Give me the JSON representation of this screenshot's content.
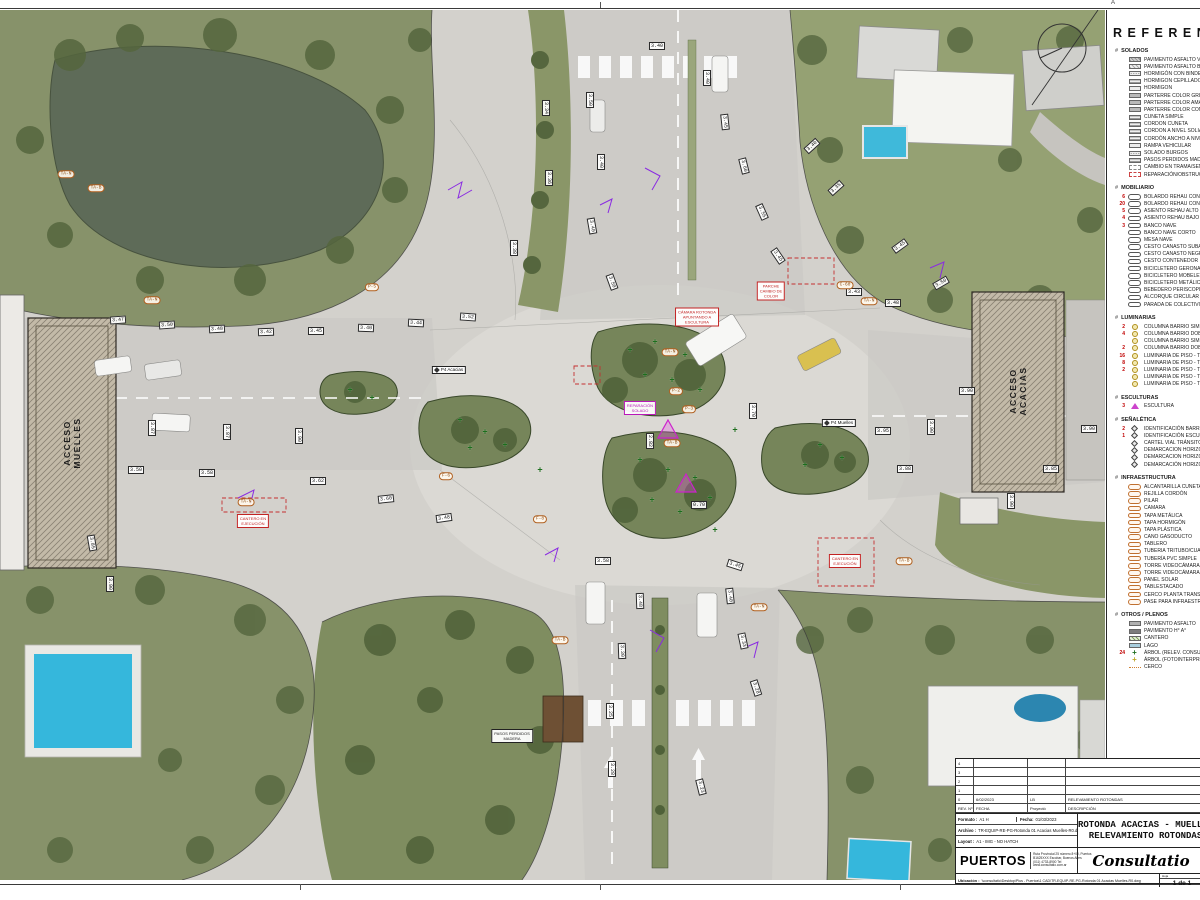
{
  "sheet": {
    "grid_letter": "A"
  },
  "legend": {
    "title": "REFERENCIAS",
    "hash": "#",
    "sections": [
      {
        "title": "SOLADOS",
        "items": [
          {
            "c": "",
            "icon": "hatch2",
            "label": "PAVIMENTO ASFALTO VEHICULAR"
          },
          {
            "c": "",
            "icon": "hatch1",
            "label": "PAVIMENTO ASFALTO BICISENDA"
          },
          {
            "c": "",
            "icon": "dots",
            "label": "HORMIGÓN CON BINDER"
          },
          {
            "c": "",
            "icon": "lines",
            "label": "HORMIGÓN CEPILLADO"
          },
          {
            "c": "",
            "icon": "light",
            "label": "HORMIGÓN"
          },
          {
            "c": "",
            "icon": "gray",
            "label": "PARTERRE COLOR GRIS"
          },
          {
            "c": "",
            "icon": "gray",
            "label": "PARTERRE COLOR AMARILLO"
          },
          {
            "c": "",
            "icon": "gray",
            "label": "PARTERRE COLOR COMB. AMARILLO Y ROJO"
          },
          {
            "c": "",
            "icon": "lines",
            "label": "CUNETA SIMPLE"
          },
          {
            "c": "",
            "icon": "lines",
            "label": "CORDÓN CUNETA"
          },
          {
            "c": "",
            "icon": "lines",
            "label": "CORDÓN A NIVEL SOLIA INTERTRABADA"
          },
          {
            "c": "",
            "icon": "lines",
            "label": "CORDÓN ANCHO A NIVEL SOLIA INTERTRABADA"
          },
          {
            "c": "",
            "icon": "light",
            "label": "RAMPA VEHICULAR"
          },
          {
            "c": "",
            "icon": "dots",
            "label": "SOLADO BURGOS"
          },
          {
            "c": "",
            "icon": "lines",
            "label": "PASOS PERDIDOS MADERA"
          },
          {
            "c": "",
            "icon": "dashg",
            "label": "CAMBIO EN TRAMA/SENTIDO ADOQUINADO"
          },
          {
            "c": "",
            "icon": "dashr",
            "label": "REPARACIÓN/OBSTRUCCIÓN EN SOLADO"
          }
        ]
      },
      {
        "title": "MOBILIARIO",
        "items": [
          {
            "c": "6",
            "icon": "oval",
            "label": "BOLARDO REHAU CON LUZ"
          },
          {
            "c": "20",
            "icon": "oval",
            "label": "BOLARDO REHAU CON REFLECTIVO"
          },
          {
            "c": "5",
            "icon": "oval",
            "label": "ASIENTO REHAU ALTO"
          },
          {
            "c": "4",
            "icon": "oval",
            "label": "ASIENTO REHAU BAJO"
          },
          {
            "c": "3",
            "icon": "oval",
            "label": "BANCO NAVE"
          },
          {
            "c": "",
            "icon": "oval",
            "label": "BANCO NAVE CORTO"
          },
          {
            "c": "",
            "icon": "oval",
            "label": "MESA NAVE"
          },
          {
            "c": "",
            "icon": "oval",
            "label": "CESTO CANASTO SUBA"
          },
          {
            "c": "",
            "icon": "oval",
            "label": "CESTO CANASTO NEGRO"
          },
          {
            "c": "",
            "icon": "oval",
            "label": "CESTO CONTENEDOR"
          },
          {
            "c": "",
            "icon": "oval",
            "label": "BICICLETERO GERONA"
          },
          {
            "c": "",
            "icon": "oval",
            "label": "BICICLETERO MOBELETTA"
          },
          {
            "c": "",
            "icon": "oval",
            "label": "BICICLETERO METÁLICO"
          },
          {
            "c": "",
            "icon": "oval",
            "label": "BEBEDERO PERISCOPIO"
          },
          {
            "c": "",
            "icon": "oval",
            "label": "ALCORQUE CIRCULAR SIMPLE"
          },
          {
            "c": "",
            "icon": "oval",
            "label": "PARADA DE COLECTIVO"
          }
        ]
      },
      {
        "title": "LUMINARIAS",
        "items": [
          {
            "c": "2",
            "icon": "circy",
            "label": "COLUMNA BARRIO SIMPLE VIAL ALTA"
          },
          {
            "c": "4",
            "icon": "circy",
            "label": "COLUMNA BARRIO DOBLE VIAL ALTA"
          },
          {
            "c": "",
            "icon": "circy",
            "label": "COLUMNA BARRIO SIMPLE PEATONAL BAJA"
          },
          {
            "c": "2",
            "icon": "circy",
            "label": "COLUMNA BARRIO DOBLE PEATONAL BAJA"
          },
          {
            "c": "16",
            "icon": "circy",
            "label": "LUMINARIA DE PISO - TIPO RECTANGULAR"
          },
          {
            "c": "8",
            "icon": "circy",
            "label": "LUMINARIA DE PISO - TIPO CILINDRO ALTO"
          },
          {
            "c": "2",
            "icon": "circy",
            "label": "LUMINARIA DE PISO - TIPO CILINDRO BAJO"
          },
          {
            "c": "",
            "icon": "circy",
            "label": "LUMINARIA DE PISO - TIPO EMPOTRABLE"
          },
          {
            "c": "",
            "icon": "circy",
            "label": "LUMINARIA DE PISO - TIPO TIRA LED"
          }
        ]
      },
      {
        "title": "ESCULTURAS",
        "items": [
          {
            "c": "3",
            "icon": "trim",
            "label": "ESCULTURA"
          }
        ]
      },
      {
        "title": "SEÑALÉTICA",
        "items": [
          {
            "c": "2",
            "icon": "diam",
            "label": "IDENTIFICACIÓN BARRIO"
          },
          {
            "c": "1",
            "icon": "diam",
            "label": "IDENTIFICACIÓN ESCULTURA"
          },
          {
            "c": "",
            "icon": "diam",
            "label": "CARTEL VIAL TRÁNSITO-ORIENTACIÓN"
          },
          {
            "c": "",
            "icon": "diam",
            "label": "DEMARCACIÓN HORIZONTAL VIAL"
          },
          {
            "c": "",
            "icon": "diam",
            "label": "DEMARCACIÓN HORIZONTAL ROTONDA"
          },
          {
            "c": "",
            "icon": "diam",
            "label": "DEMARCACIÓN HORIZONTAL BICISENDA"
          }
        ]
      },
      {
        "title": "INFRAESTRUCTURA",
        "items": [
          {
            "c": "",
            "icon": "ovalo",
            "label": "ALCANTARILLA CUNETA"
          },
          {
            "c": "",
            "icon": "ovalo",
            "label": "REJILLA CORDÓN"
          },
          {
            "c": "",
            "icon": "ovalo",
            "label": "PILAR"
          },
          {
            "c": "",
            "icon": "ovalo",
            "label": "CÁMARA"
          },
          {
            "c": "",
            "icon": "ovalo",
            "label": "TAPA METÁLICA"
          },
          {
            "c": "",
            "icon": "ovalo",
            "label": "TAPA HORMIGÓN"
          },
          {
            "c": "",
            "icon": "ovalo",
            "label": "TAPA PLÁSTICA"
          },
          {
            "c": "",
            "icon": "ovalo",
            "label": "CAÑO GASODUCTO"
          },
          {
            "c": "",
            "icon": "ovalo",
            "label": "TABLERO"
          },
          {
            "c": "",
            "icon": "ovalo",
            "label": "TUBERÍA TRITUBO/CUATRITUBO"
          },
          {
            "c": "",
            "icon": "ovalo",
            "label": "TUBERÍA PVC SIMPLE"
          },
          {
            "c": "",
            "icon": "ovalo",
            "label": "TORRE VIDEOCÁMARA SIMPLE"
          },
          {
            "c": "",
            "icon": "ovalo",
            "label": "TORRE VIDEOCÁMARA MÚLTIPLE"
          },
          {
            "c": "",
            "icon": "ovalo",
            "label": "PANEL SOLAR"
          },
          {
            "c": "",
            "icon": "ovalo",
            "label": "TABLESTACADO"
          },
          {
            "c": "",
            "icon": "ovalo",
            "label": "CERCO PLANTA TRANSFORMADORA"
          },
          {
            "c": "",
            "icon": "ovalo",
            "label": "PASE PARA INFRAESTRUCTURA (EN DESUSO)"
          }
        ]
      },
      {
        "title": "OTROS / PLENOS",
        "items": [
          {
            "c": "",
            "icon": "swasph",
            "label": "PAVIMENTO ASFALTO"
          },
          {
            "c": "",
            "icon": "swha",
            "label": "PAVIMENTO H° A°"
          },
          {
            "c": "",
            "icon": "swcant",
            "label": "CANTERO"
          },
          {
            "c": "",
            "icon": "swlago",
            "label": "LAGO"
          },
          {
            "c": "24",
            "icon": "plusg",
            "label": "ÁRBOL (RELEV. CONSULTATIO)"
          },
          {
            "c": "",
            "icon": "plusy",
            "label": "ÁRBOL (FOTOINTERPRETACIÓN)"
          },
          {
            "c": "",
            "icon": "cerco",
            "label": "CERCO"
          }
        ]
      }
    ]
  },
  "title_block": {
    "rev_table": {
      "headers": [
        "REV. Nº",
        "FECHA",
        "Proyectó",
        "DESCRIPCIÓN"
      ],
      "rows": [
        [
          "4",
          "",
          "",
          ""
        ],
        [
          "3",
          "",
          "",
          ""
        ],
        [
          "2",
          "",
          "",
          ""
        ],
        [
          "1",
          "",
          "",
          ""
        ],
        [
          "0",
          "6/02/2023",
          "LB",
          "RELEVAMIENTO ROTONDAS"
        ]
      ]
    },
    "formato_label": "Formato :",
    "formato": "A1 H",
    "fecha_label": "Fecha:",
    "fecha": "01/03/2023",
    "archivo_label": "Archivo :",
    "archivo": "TR-EQUIP-RE-PG-Rotonda 01 Acacias Muelles-R0.dwg",
    "layout_label": "Layout :",
    "layout": "A1 - IMG - NO HATCH",
    "title_lines": [
      "ROTONDA ACACIAS - MUELLES",
      "RELEVAMIENTO ROTONDAS"
    ],
    "brand": {
      "name": "PUERTOS",
      "address": [
        "Ruta Provincial 25 número 8+00, Puertos",
        "B1625XXX Escobar, Buenos Aires",
        "(011) 4733-8900  Tel",
        "www.consultatio.com.ar"
      ],
      "consultatio": "Consultatio"
    },
    "ubicacion_label": "Ubicación :",
    "ubicacion": "\\\\consultatio\\Desktop\\Plus - Puertos\\1 CAD\\TR-EQUIP-RE-PG-Rotonda 01 Acacias Muelles-R0.dwg",
    "hoja_label": "Hoja",
    "hoja": "1 de 1"
  },
  "map": {
    "building_labels": [
      {
        "line1": "ACCESO",
        "line2": "MUELLES",
        "x": 72,
        "y": 443
      },
      {
        "line1": "ACCESO",
        "line2": "ACACIAS",
        "x": 1018,
        "y": 391
      }
    ],
    "dims": [
      {
        "t": "3.34",
        "x": 546,
        "y": 108,
        "r": 90
      },
      {
        "t": "3.36",
        "x": 549,
        "y": 178,
        "r": 90
      },
      {
        "t": "3.38",
        "x": 514,
        "y": 248,
        "r": 90
      },
      {
        "t": "3.50",
        "x": 590,
        "y": 100,
        "r": 90
      },
      {
        "t": "3.40",
        "x": 601,
        "y": 162,
        "r": 90
      },
      {
        "t": "3.40",
        "x": 592,
        "y": 226,
        "r": 80
      },
      {
        "t": "3.50",
        "x": 612,
        "y": 282,
        "r": 70
      },
      {
        "t": "3.40",
        "x": 657,
        "y": 46,
        "r": 0
      },
      {
        "t": "3.40",
        "x": 707,
        "y": 78,
        "r": 90
      },
      {
        "t": "3.45",
        "x": 725,
        "y": 122,
        "r": 84
      },
      {
        "t": "3.60",
        "x": 744,
        "y": 166,
        "r": 76
      },
      {
        "t": "3.55",
        "x": 762,
        "y": 212,
        "r": 66
      },
      {
        "t": "3.45",
        "x": 778,
        "y": 256,
        "r": 56
      },
      {
        "t": "3.40",
        "x": 812,
        "y": 146,
        "r": -42
      },
      {
        "t": "3.35",
        "x": 836,
        "y": 188,
        "r": -42
      },
      {
        "t": "3.45",
        "x": 900,
        "y": 246,
        "r": -36
      },
      {
        "t": "3.50",
        "x": 941,
        "y": 283,
        "r": -30
      },
      {
        "t": "3.48",
        "x": 893,
        "y": 303,
        "r": 0
      },
      {
        "t": "3.43",
        "x": 854,
        "y": 292,
        "r": 0
      },
      {
        "t": "3.47",
        "x": 118,
        "y": 320,
        "r": -4
      },
      {
        "t": "3.50",
        "x": 167,
        "y": 325,
        "r": -4
      },
      {
        "t": "3.48",
        "x": 217,
        "y": 329,
        "r": -3
      },
      {
        "t": "3.42",
        "x": 266,
        "y": 332,
        "r": -2
      },
      {
        "t": "3.45",
        "x": 316,
        "y": 331,
        "r": 0
      },
      {
        "t": "3.40",
        "x": 366,
        "y": 328,
        "r": 2
      },
      {
        "t": "3.44",
        "x": 416,
        "y": 323,
        "r": 3
      },
      {
        "t": "3.52",
        "x": 468,
        "y": 317,
        "r": 4
      },
      {
        "t": "3.87",
        "x": 152,
        "y": 428,
        "r": 90
      },
      {
        "t": "3.87",
        "x": 227,
        "y": 432,
        "r": 90
      },
      {
        "t": "3.90",
        "x": 299,
        "y": 436,
        "r": 90
      },
      {
        "t": "3.50",
        "x": 136,
        "y": 470,
        "r": 0
      },
      {
        "t": "3.58",
        "x": 207,
        "y": 473,
        "r": 0
      },
      {
        "t": "3.62",
        "x": 318,
        "y": 481,
        "r": 0
      },
      {
        "t": "3.60",
        "x": 386,
        "y": 499,
        "r": -6
      },
      {
        "t": "3.48",
        "x": 444,
        "y": 518,
        "r": -8
      },
      {
        "t": "3.85",
        "x": 92,
        "y": 543,
        "r": 80
      },
      {
        "t": "3.90",
        "x": 110,
        "y": 584,
        "r": 90
      },
      {
        "t": "3.70",
        "x": 753,
        "y": 411,
        "r": 90
      },
      {
        "t": "2.82",
        "x": 650,
        "y": 441,
        "r": 90
      },
      {
        "t": "0.70",
        "x": 699,
        "y": 505,
        "r": 0
      },
      {
        "t": "3.95",
        "x": 883,
        "y": 431,
        "r": 0
      },
      {
        "t": "3.90",
        "x": 931,
        "y": 427,
        "r": 90
      },
      {
        "t": "3.90",
        "x": 967,
        "y": 391,
        "r": 0
      },
      {
        "t": "3.88",
        "x": 905,
        "y": 469,
        "r": 0
      },
      {
        "t": "3.90",
        "x": 1011,
        "y": 501,
        "r": 90
      },
      {
        "t": "3.85",
        "x": 1051,
        "y": 469,
        "r": 0
      },
      {
        "t": "3.90",
        "x": 1089,
        "y": 429,
        "r": 0
      },
      {
        "t": "3.58",
        "x": 603,
        "y": 561,
        "r": 0
      },
      {
        "t": "3.45",
        "x": 735,
        "y": 565,
        "r": 18
      },
      {
        "t": "3.48",
        "x": 640,
        "y": 601,
        "r": 88
      },
      {
        "t": "3.40",
        "x": 730,
        "y": 596,
        "r": 84
      },
      {
        "t": "3.33",
        "x": 743,
        "y": 641,
        "r": 78
      },
      {
        "t": "3.28",
        "x": 756,
        "y": 688,
        "r": 72
      },
      {
        "t": "3.30",
        "x": 622,
        "y": 651,
        "r": 88
      },
      {
        "t": "3.25",
        "x": 610,
        "y": 711,
        "r": 90
      },
      {
        "t": "3.28",
        "x": 612,
        "y": 769,
        "r": 90
      },
      {
        "t": "3.23",
        "x": 701,
        "y": 787,
        "r": 76
      }
    ],
    "ovals": [
      {
        "t": "TA-N",
        "x": 670,
        "y": 352
      },
      {
        "t": "P-2",
        "x": 676,
        "y": 391
      },
      {
        "t": "P-3",
        "x": 689,
        "y": 409
      },
      {
        "t": "TA-B",
        "x": 672,
        "y": 443
      },
      {
        "t": "TA-N",
        "x": 152,
        "y": 300
      },
      {
        "t": "TA-B",
        "x": 96,
        "y": 188
      },
      {
        "t": "TA-N",
        "x": 66,
        "y": 174
      },
      {
        "t": "P-5",
        "x": 372,
        "y": 287
      },
      {
        "t": "F-6",
        "x": 446,
        "y": 476
      },
      {
        "t": "TA-N",
        "x": 869,
        "y": 301
      },
      {
        "t": "TA-B",
        "x": 904,
        "y": 561
      },
      {
        "t": "TA-N",
        "x": 759,
        "y": 607
      },
      {
        "t": "C-60",
        "x": 845,
        "y": 285
      },
      {
        "t": "F-8",
        "x": 540,
        "y": 519
      },
      {
        "t": "TA-N",
        "x": 246,
        "y": 502
      },
      {
        "t": "TA-B",
        "x": 560,
        "y": 640
      }
    ],
    "signs": [
      {
        "t": "P4 Acacias",
        "x": 449,
        "y": 370
      },
      {
        "t": "P4 Muelles",
        "x": 839,
        "y": 423
      }
    ],
    "notes": [
      {
        "lines": [
          "PARCHE",
          "CAMBIO DE",
          "COLOR"
        ],
        "x": 771,
        "y": 291,
        "c": "red"
      },
      {
        "lines": [
          "CÁMARA ROTONDA",
          "APUNTANDO A",
          "ESCULTURA"
        ],
        "x": 697,
        "y": 317,
        "c": "red"
      },
      {
        "lines": [
          "CANTERO EN",
          "EJECUCIÓN"
        ],
        "x": 253,
        "y": 521,
        "c": "red"
      },
      {
        "lines": [
          "CANTERO EN",
          "EJECUCIÓN"
        ],
        "x": 845,
        "y": 561,
        "c": "red"
      },
      {
        "lines": [
          "REPARACIÓN",
          "SOLADO"
        ],
        "x": 640,
        "y": 408,
        "c": "magenta"
      },
      {
        "lines": [
          "PASOS PERDIDOS",
          "MADERA"
        ],
        "x": 512,
        "y": 736,
        "c": "black"
      }
    ],
    "trees": [
      [
        630,
        350
      ],
      [
        655,
        342
      ],
      [
        685,
        355
      ],
      [
        645,
        375
      ],
      [
        672,
        380
      ],
      [
        700,
        390
      ],
      [
        640,
        460
      ],
      [
        668,
        470
      ],
      [
        695,
        478
      ],
      [
        652,
        500
      ],
      [
        680,
        512
      ],
      [
        710,
        498
      ],
      [
        460,
        420
      ],
      [
        485,
        432
      ],
      [
        505,
        445
      ],
      [
        470,
        448
      ],
      [
        820,
        445
      ],
      [
        842,
        458
      ],
      [
        805,
        465
      ],
      [
        350,
        390
      ],
      [
        372,
        398
      ],
      [
        540,
        470
      ],
      [
        735,
        430
      ],
      [
        715,
        530
      ]
    ]
  }
}
